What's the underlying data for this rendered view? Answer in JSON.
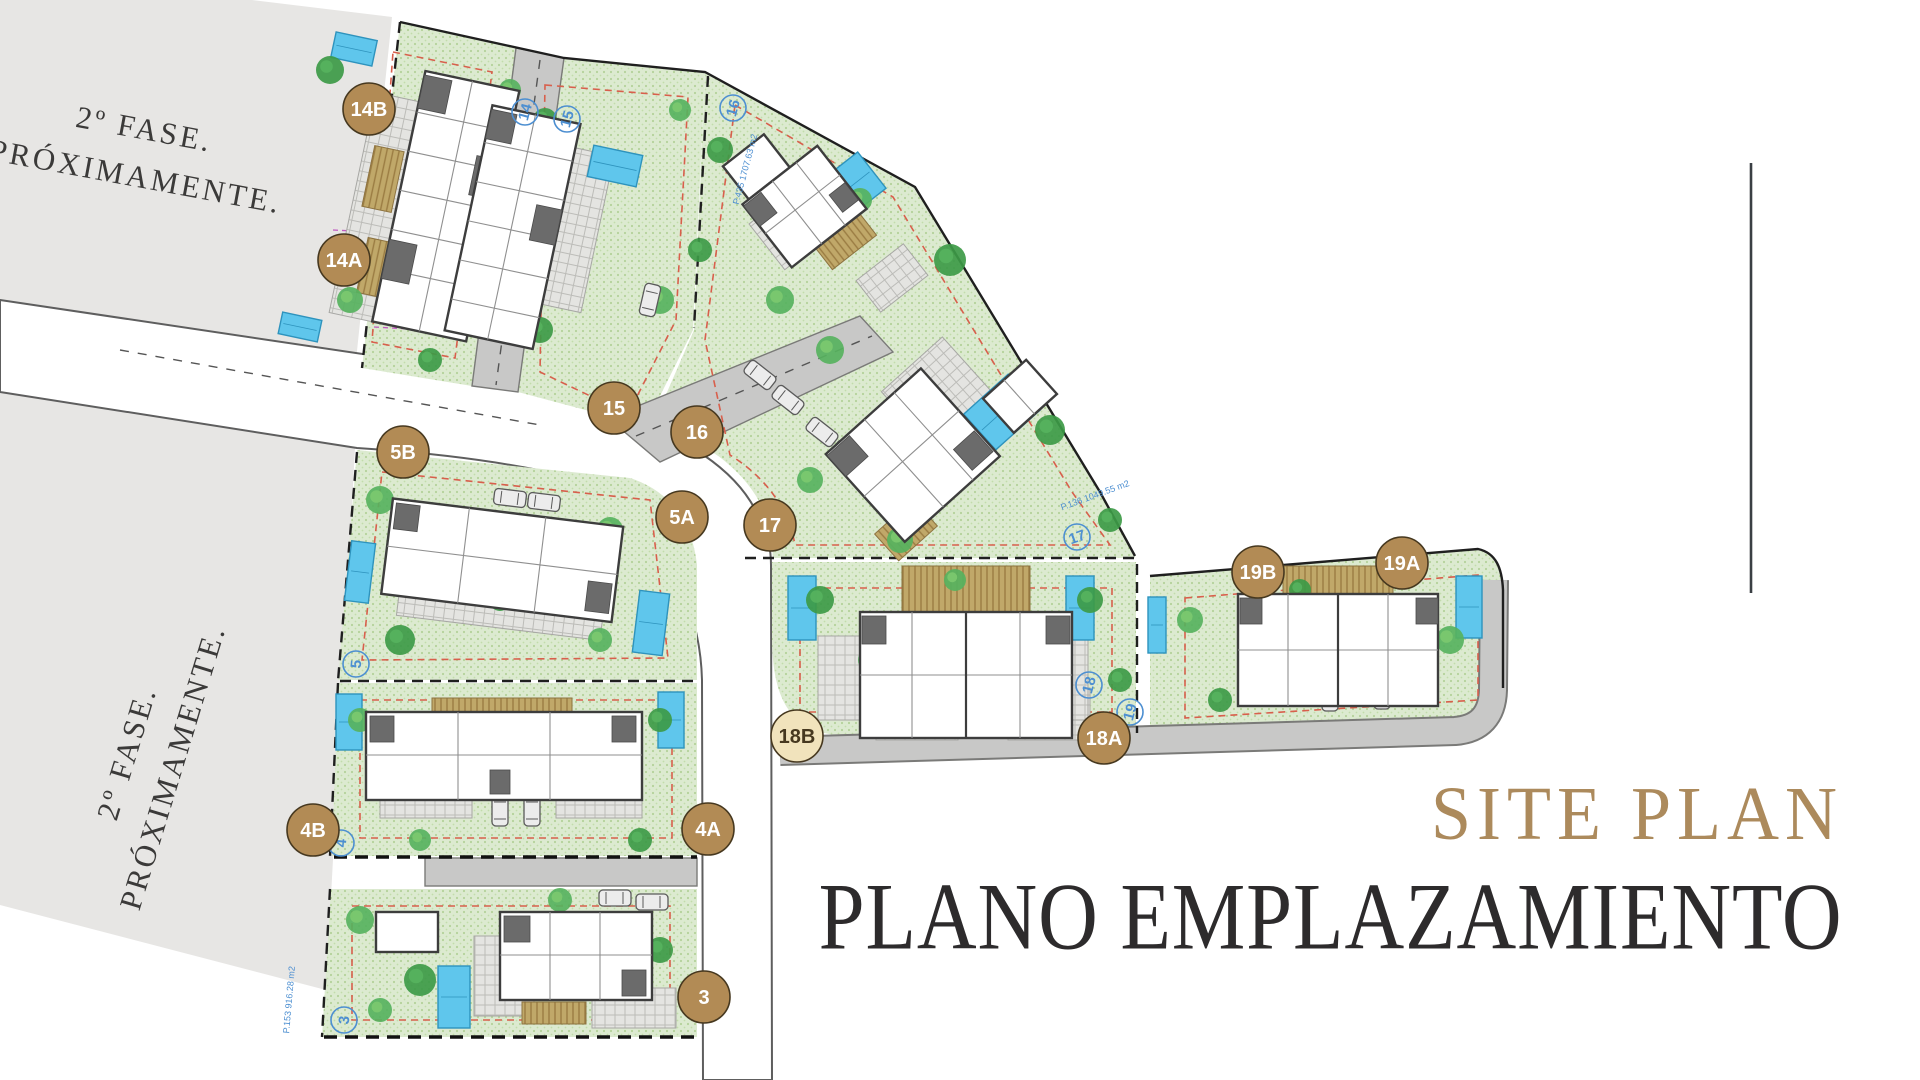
{
  "titles": {
    "en": "SITE PLAN",
    "es": "PLANO EMPLAZAMIENTO"
  },
  "phase_notice": {
    "line1": "2º FASE.",
    "line2": "PRÓXIMAMENTE."
  },
  "markers": [
    {
      "label": "14B",
      "x": 369,
      "y": 109,
      "variant": "solid"
    },
    {
      "label": "14A",
      "x": 344,
      "y": 260,
      "variant": "solid"
    },
    {
      "label": "15",
      "x": 614,
      "y": 408,
      "variant": "solid"
    },
    {
      "label": "16",
      "x": 697,
      "y": 432,
      "variant": "solid"
    },
    {
      "label": "17",
      "x": 770,
      "y": 525,
      "variant": "solid"
    },
    {
      "label": "5B",
      "x": 403,
      "y": 452,
      "variant": "solid"
    },
    {
      "label": "5A",
      "x": 682,
      "y": 517,
      "variant": "solid"
    },
    {
      "label": "18B",
      "x": 797,
      "y": 736,
      "variant": "light"
    },
    {
      "label": "18A",
      "x": 1104,
      "y": 738,
      "variant": "solid"
    },
    {
      "label": "19B",
      "x": 1258,
      "y": 572,
      "variant": "solid"
    },
    {
      "label": "19A",
      "x": 1402,
      "y": 563,
      "variant": "solid"
    },
    {
      "label": "4B",
      "x": 313,
      "y": 830,
      "variant": "solid"
    },
    {
      "label": "4A",
      "x": 708,
      "y": 829,
      "variant": "solid"
    },
    {
      "label": "3",
      "x": 704,
      "y": 997,
      "variant": "solid"
    }
  ],
  "plot_badges": [
    {
      "label": "14",
      "x": 525,
      "y": 112,
      "rot": -75
    },
    {
      "label": "15",
      "x": 567,
      "y": 119,
      "rot": -75
    },
    {
      "label": "16",
      "x": 733,
      "y": 108,
      "rot": -75
    },
    {
      "label": "17",
      "x": 1077,
      "y": 537,
      "rot": -20
    },
    {
      "label": "18",
      "x": 1089,
      "y": 685,
      "rot": -75
    },
    {
      "label": "19",
      "x": 1130,
      "y": 712,
      "rot": -75
    },
    {
      "label": "5",
      "x": 356,
      "y": 664,
      "rot": -85
    },
    {
      "label": "4",
      "x": 341,
      "y": 843,
      "rot": -85
    },
    {
      "label": "3",
      "x": 344,
      "y": 1020,
      "rot": -85
    }
  ],
  "area_labels": [
    {
      "text": "P.435  1707.63 m2",
      "x": 748,
      "y": 170,
      "rot": -75
    },
    {
      "text": "P.136  1049.55 m2",
      "x": 1096,
      "y": 498,
      "rot": -20
    },
    {
      "text": "P.153  916.28 m2",
      "x": 292,
      "y": 1000,
      "rot": -85
    }
  ],
  "colors": {
    "marker_fill": "#b28b55",
    "marker_stroke": "#46381f",
    "marker_text": "#ffffff",
    "marker_light_fill": "#f1e3bc",
    "marker_light_text": "#46381f",
    "badge_blue": "#4d8fd1",
    "accent_gold": "#ac8a5c",
    "title_dark": "#2d2b2c",
    "grass": "#dcead0",
    "road": "#c8c8c7",
    "phase_gray": "#e7e6e4",
    "pool": "#5fc6ec"
  }
}
